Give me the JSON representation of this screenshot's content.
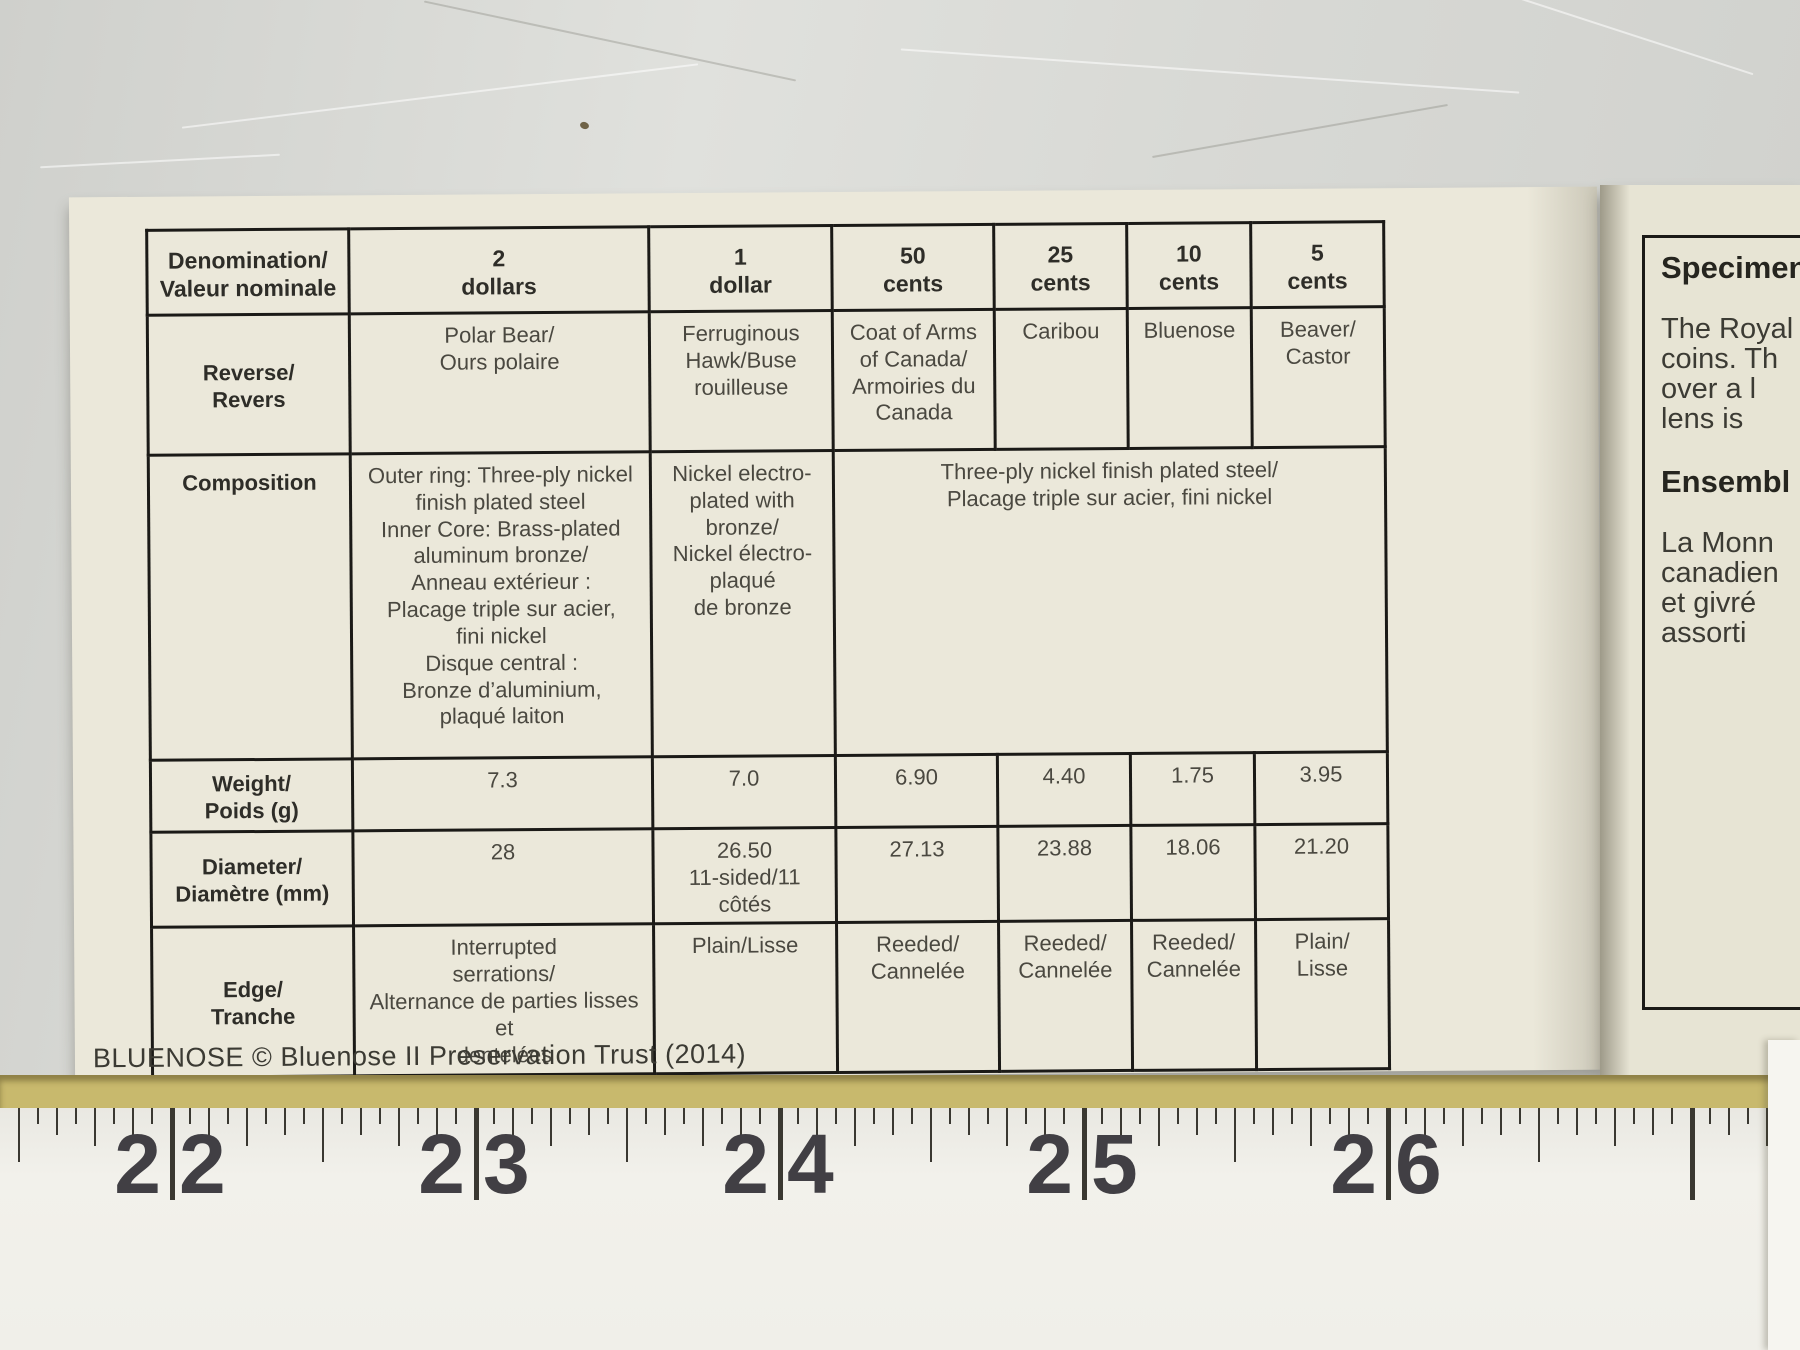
{
  "caption": "BLUENOSE © Bluenose II Preservation Trust (2014)",
  "table": {
    "header": {
      "corner": "Denomination/\nValeur nominale",
      "cols": [
        "2\ndollars",
        "1\ndollar",
        "50\ncents",
        "25\ncents",
        "10\ncents",
        "5\ncents"
      ]
    },
    "rows": [
      {
        "label": "Reverse/\nRevers",
        "cells": [
          "Polar Bear/\nOurs polaire",
          "Ferruginous\nHawk/Buse\nrouilleuse",
          "Coat of Arms\nof Canada/\nArmoiries du\nCanada",
          "Caribou",
          "Bluenose",
          "Beaver/\nCastor"
        ]
      },
      {
        "label": "Composition",
        "cells": [
          "Outer ring: Three-ply nickel\nfinish plated steel\nInner Core: Brass-plated\naluminum bronze/\nAnneau extérieur :\nPlacage triple sur acier,\nfini nickel\nDisque central :\nBronze d’aluminium,\nplaqué laiton",
          "Nickel electro-\nplated with\nbronze/\nNickel électro-\nplaqué\nde bronze",
          "Three-ply nickel finish plated steel/\nPlacage triple sur acier, fini nickel"
        ]
      },
      {
        "label": "Weight/\nPoids (g)",
        "cells": [
          "7.3",
          "7.0",
          "6.90",
          "4.40",
          "1.75",
          "3.95"
        ]
      },
      {
        "label": "Diameter/\nDiamètre (mm)",
        "cells": [
          "28",
          "26.50\n11-sided/11 côtés",
          "27.13",
          "23.88",
          "18.06",
          "21.20"
        ]
      },
      {
        "label": "Edge/\nTranche",
        "cells": [
          "Interrupted\nserrations/\nAlternance de parties lisses et\ndentelées",
          "Plain/Lisse",
          "Reeded/\nCannelée",
          "Reeded/\nCannelée",
          "Reeded/\nCannelée",
          "Plain/\nLisse"
        ]
      }
    ]
  },
  "specimen": {
    "title": "Specimen",
    "lines": [
      "The Royal",
      "coins. Th",
      "over a l",
      "lens is"
    ],
    "subtitle": "Ensembl",
    "lines2": [
      "La Monn",
      "canadien",
      "et givré",
      "assorti"
    ]
  },
  "ruler": {
    "numbers": [
      "22",
      "23",
      "24",
      "25",
      "26"
    ]
  },
  "colors": {
    "page_cream": "#ebe8da",
    "ink_black": "#1b1a17",
    "ruler_yellow_edge": "#c8b96d"
  }
}
